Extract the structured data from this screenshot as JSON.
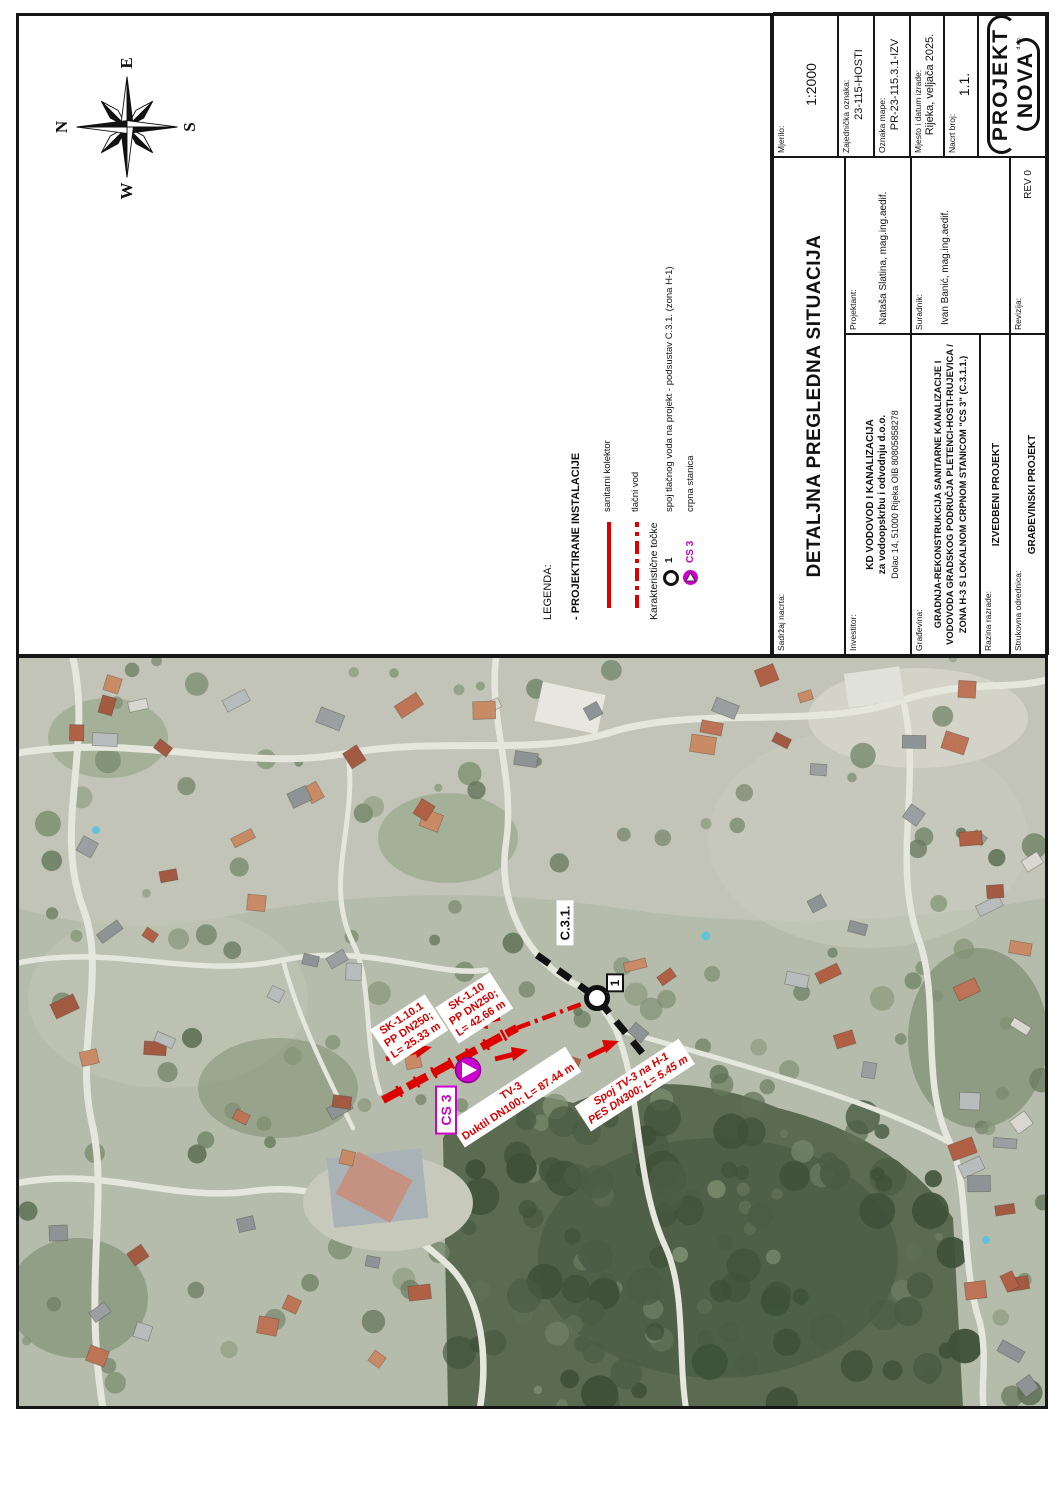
{
  "colors": {
    "annotation_red": "#dc0000",
    "annotation_magenta": "#cc00cc",
    "frame": "#161616"
  },
  "compass": {
    "n": "N",
    "e": "E",
    "s": "S",
    "w": "W"
  },
  "legend": {
    "title": "LEGENDA:",
    "section_installations": "- PROJEKTIRANE INSTALACIJE",
    "items": [
      {
        "symbol": "solid-red-line",
        "label": "sanitarni kolektor"
      },
      {
        "symbol": "dashdot-red-line",
        "label": "tlačni vod"
      }
    ],
    "section_points": "Karakteristične točke",
    "points": [
      {
        "id": "1",
        "symbol": "circle-marker",
        "label": "spoj tlačnog voda na projekt - podsustav C.3.1. (zona H-1)"
      },
      {
        "id": "CS 3",
        "symbol": "pump-station",
        "label": "crpna stanica"
      }
    ]
  },
  "titleblock": {
    "sadrzaj_label": "Sadržaj nacrta:",
    "sadrzaj_value": "DETALJNA PREGLEDNA SITUACIJA",
    "mjerilo_label": "Mjerilo:",
    "mjerilo_value": "1:2000",
    "zajednicka_label": "Zajednička oznaka:",
    "zajednicka_value": "23-115-HOSTI",
    "oznaka_label": "Oznaka mape:",
    "oznaka_value": "PR-23-115.3.1-IZV",
    "mjesto_label": "Mjesto i datum izrade:",
    "mjesto_value": "Rijeka, veljača 2025.",
    "nacrt_label": "Nacrt broj:",
    "nacrt_value": "1.1.",
    "investitor_label": "Investitor:",
    "investitor_line1": "KD VODOVOD I KANALIZACIJA",
    "investitor_line2": "za vodoopskrbu i odvodnju d.o.o.",
    "investitor_line3": "Dolac 14, 51000 Rijeka OIB 80805858278",
    "projektant_label": "Projektant:",
    "projektant_value": "Nataša Slatina, mag.ing.aedif.",
    "gradjevina_label": "Građevina:",
    "gradjevina_line1": "GRADNJA-REKONSTRUKCIJA SANITARNE KANALIZACIJE I",
    "gradjevina_line2": "VODOVODA GRADSKOG PODRUČJA PLETENCI-HOSTI-RUJEVICA /",
    "gradjevina_line3": "ZONA H-3 S LOKALNOM CRPNOM STANICOM \"CS 3\" (C.3.1.1.)",
    "suradnik_label": "Suradnik:",
    "suradnik_value": "Ivan Banić, mag.ing.aedif.",
    "razina_label": "Razina razrade:",
    "razina_value": "IZVEDBENI PROJEKT",
    "strukovna_label": "Strukovna odrednica:",
    "strukovna_value": "GRAĐEVINSKI PROJEKT",
    "revizija_label": "Revizija:",
    "revizija_value": "REV 0",
    "logo_line1": "PROJEKT",
    "logo_line2": "NOVA",
    "logo_suffix": "d.o.o."
  },
  "map": {
    "labels": {
      "sk1101": {
        "line1": "SK-1.10.1",
        "line2": "PP DN250;",
        "line3": "L= 25.33 m"
      },
      "sk110": {
        "line1": "SK-1.10",
        "line2": "PP DN250;",
        "line3": "L= 42.66 m"
      },
      "tv3": {
        "line1": "TV-3",
        "line2": "Duktil DN100; L= 87.44 m"
      },
      "spoj": {
        "line1": "Spoj TV-3 na H-1",
        "line2": "PES DN300; L= 5.45 m"
      },
      "cs3": "CS 3",
      "c31": "C.3.1.",
      "point1": "1"
    }
  }
}
